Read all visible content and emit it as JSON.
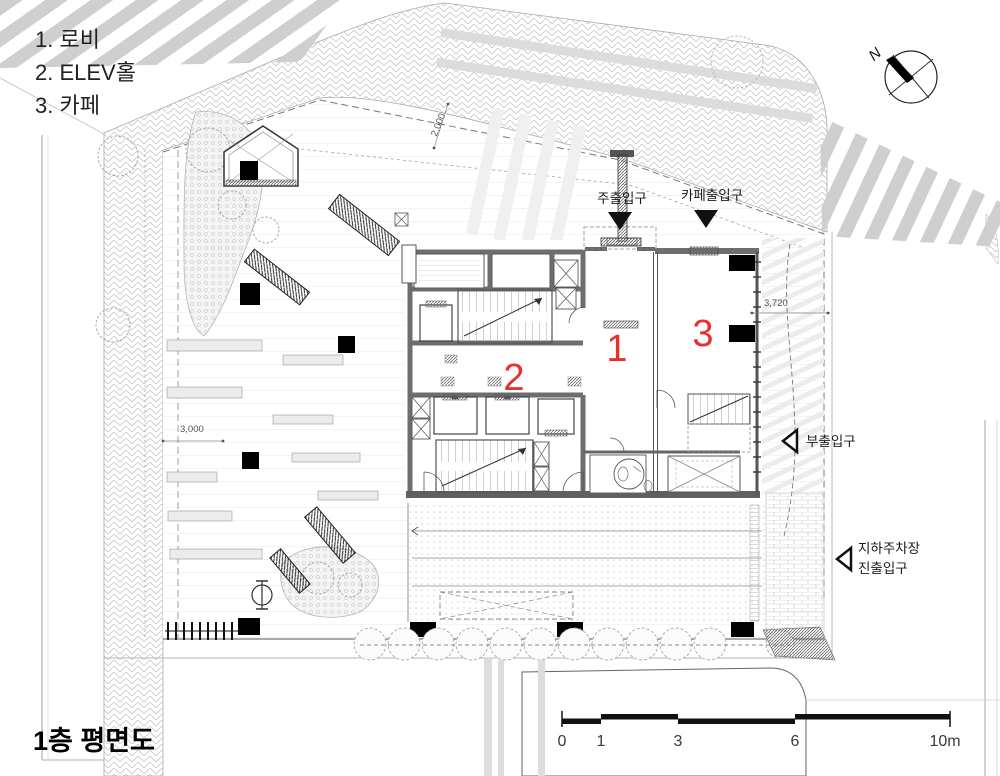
{
  "title": "1층 평면도",
  "legend": {
    "items": [
      "1. 로비",
      "2. ELEV홀",
      "3. 카페"
    ]
  },
  "compass": {
    "label": "N"
  },
  "entrances": {
    "main": "주출입구",
    "cafe": "카페출입구",
    "side": "부출입구",
    "parking_line1": "지하주차장",
    "parking_line2": "진출입구"
  },
  "rooms": {
    "lobby": "1",
    "hall": "2",
    "cafe": "3"
  },
  "dimensions": {
    "sidewalk": "2,000",
    "plaza": "3,000",
    "ramp": "3,720"
  },
  "scalebar": {
    "labels": [
      "0",
      "1",
      "3",
      "6",
      "10m"
    ]
  },
  "colors": {
    "accent_red": "#e8312a",
    "wall_gray": "#6e6e6e"
  }
}
